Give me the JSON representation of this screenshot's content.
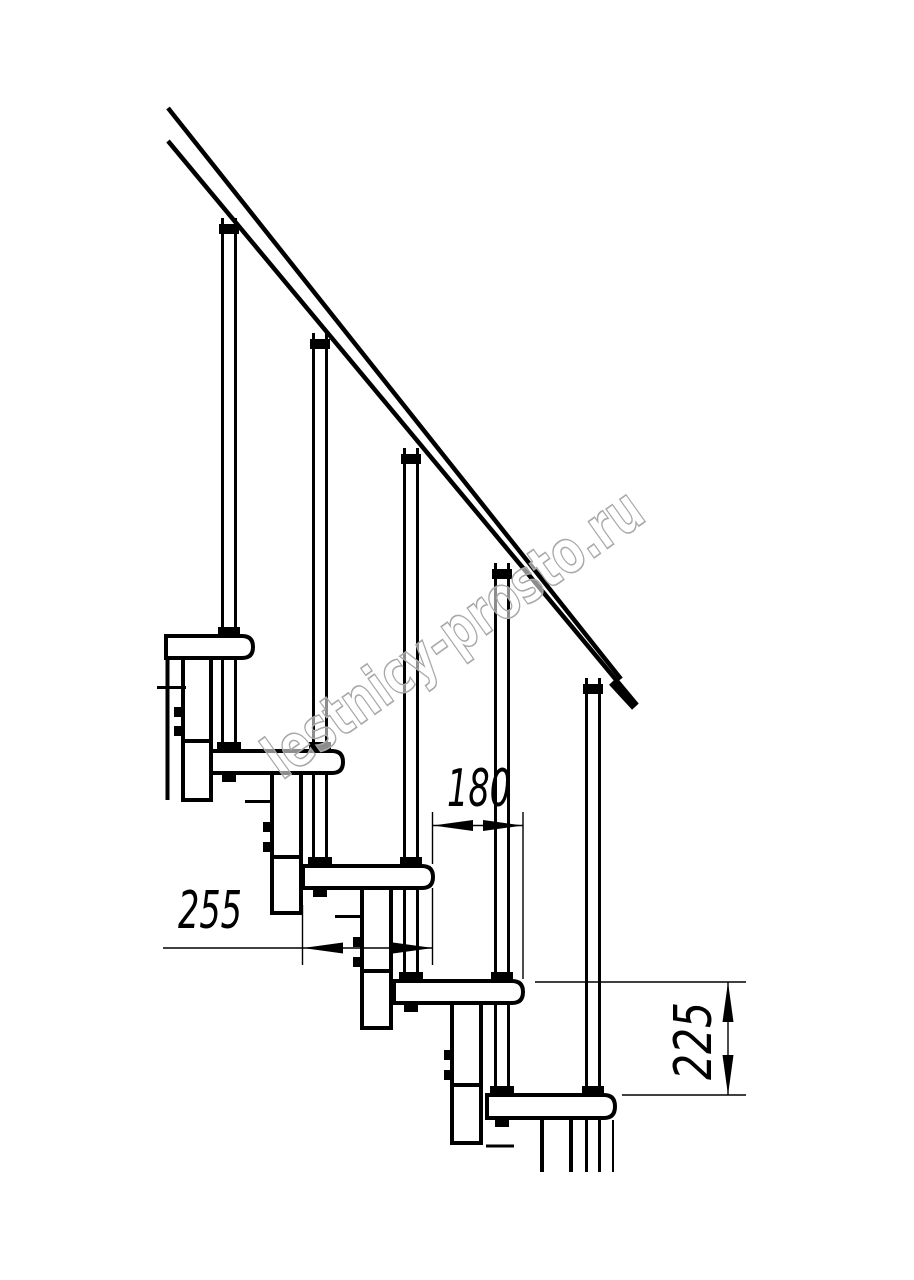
{
  "canvas": {
    "background": "#ffffff",
    "line_color": "#000000"
  },
  "dimensions": {
    "tread_depth": {
      "value": "255"
    },
    "going": {
      "value": "180"
    },
    "rise": {
      "value": "225"
    }
  },
  "watermark": {
    "text": "lestnicy-prosto.ru",
    "color": "#a8a8a8"
  }
}
